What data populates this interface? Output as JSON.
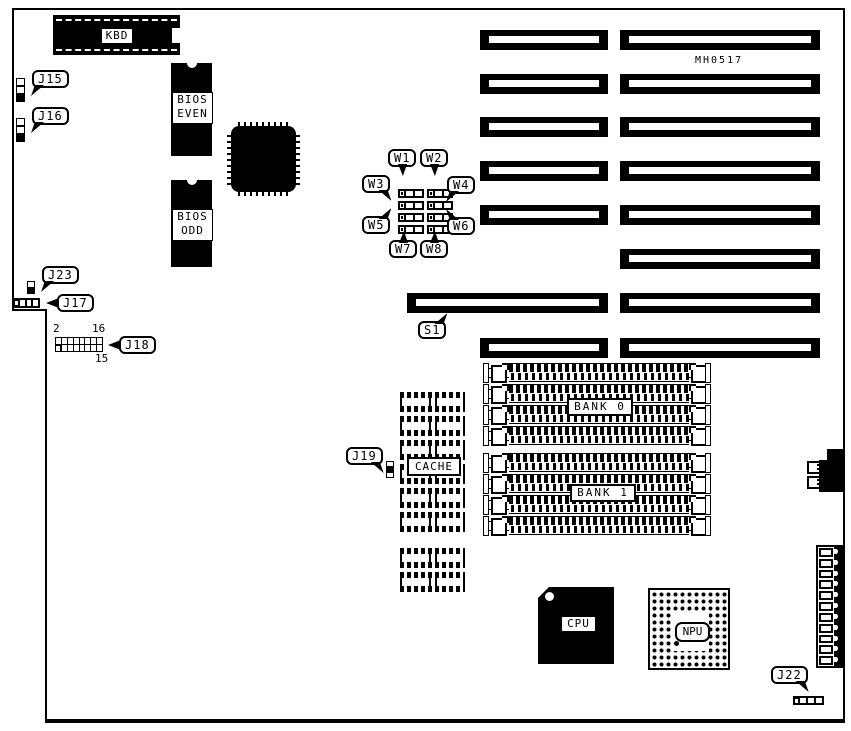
{
  "diagram": {
    "part_number": "MH0517",
    "callouts": {
      "j15": "J15",
      "j16": "J16",
      "j17": "J17",
      "j18": "J18",
      "j19": "J19",
      "j22": "J22",
      "j23": "J23",
      "s1": "S1",
      "w1": "W1",
      "w2": "W2",
      "w3": "W3",
      "w4": "W4",
      "w5": "W5",
      "w6": "W6",
      "w7": "W7",
      "w8": "W8"
    },
    "chips": {
      "kbd": "KBD",
      "bios_even_1": "BIOS",
      "bios_even_2": "EVEN",
      "bios_odd_1": "BIOS",
      "bios_odd_2": "ODD",
      "cpu": "CPU",
      "npu": "NPU",
      "cache": "CACHE"
    },
    "memory_banks": {
      "bank0": "BANK 0",
      "bank1": "BANK 1"
    },
    "j18_pin_numbers": {
      "top_left": "2",
      "top_right": "16",
      "bottom_right": "15"
    },
    "colors": {
      "ink": "#000000",
      "background": "#ffffff"
    }
  }
}
